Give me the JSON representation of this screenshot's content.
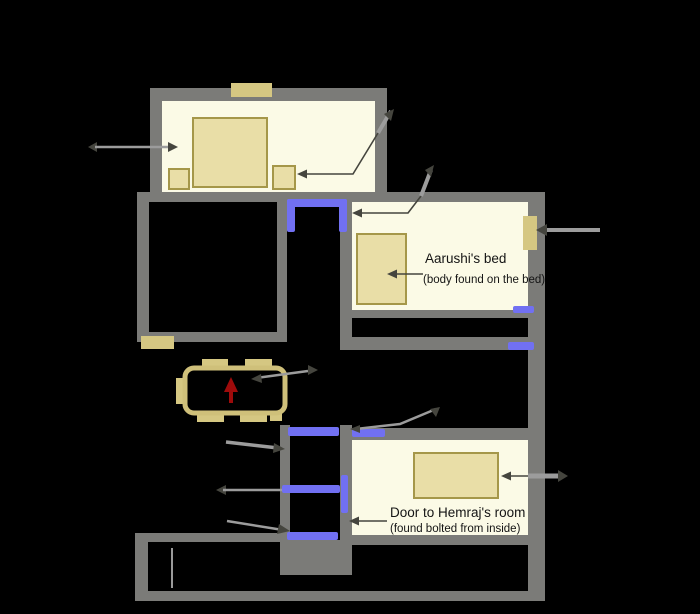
{
  "diagram": {
    "type": "floor-plan",
    "background": "#000000",
    "colors": {
      "background": "#000000",
      "wall": "#7b7b78",
      "room_fill": "#fbfae6",
      "furniture_fill": "#e9dea7",
      "furniture_border": "#a59749",
      "window_tan": "#d5c782",
      "table_outline": "#cfc07a",
      "door_blue": "#7170f2",
      "arrow_red": "#9e0b0b",
      "leader_light": "#9c9c9c",
      "leader_dark": "#45453e",
      "stair_line": "#9a9a9a",
      "label_text": "#141414"
    },
    "labels": {
      "aarushi_bed": {
        "title": "Aarushi's bed",
        "subtitle": "(body found on the bed)"
      },
      "hemraj_door": {
        "title": "Door to Hemraj's room",
        "subtitle": "(found bolted from inside)"
      }
    }
  }
}
